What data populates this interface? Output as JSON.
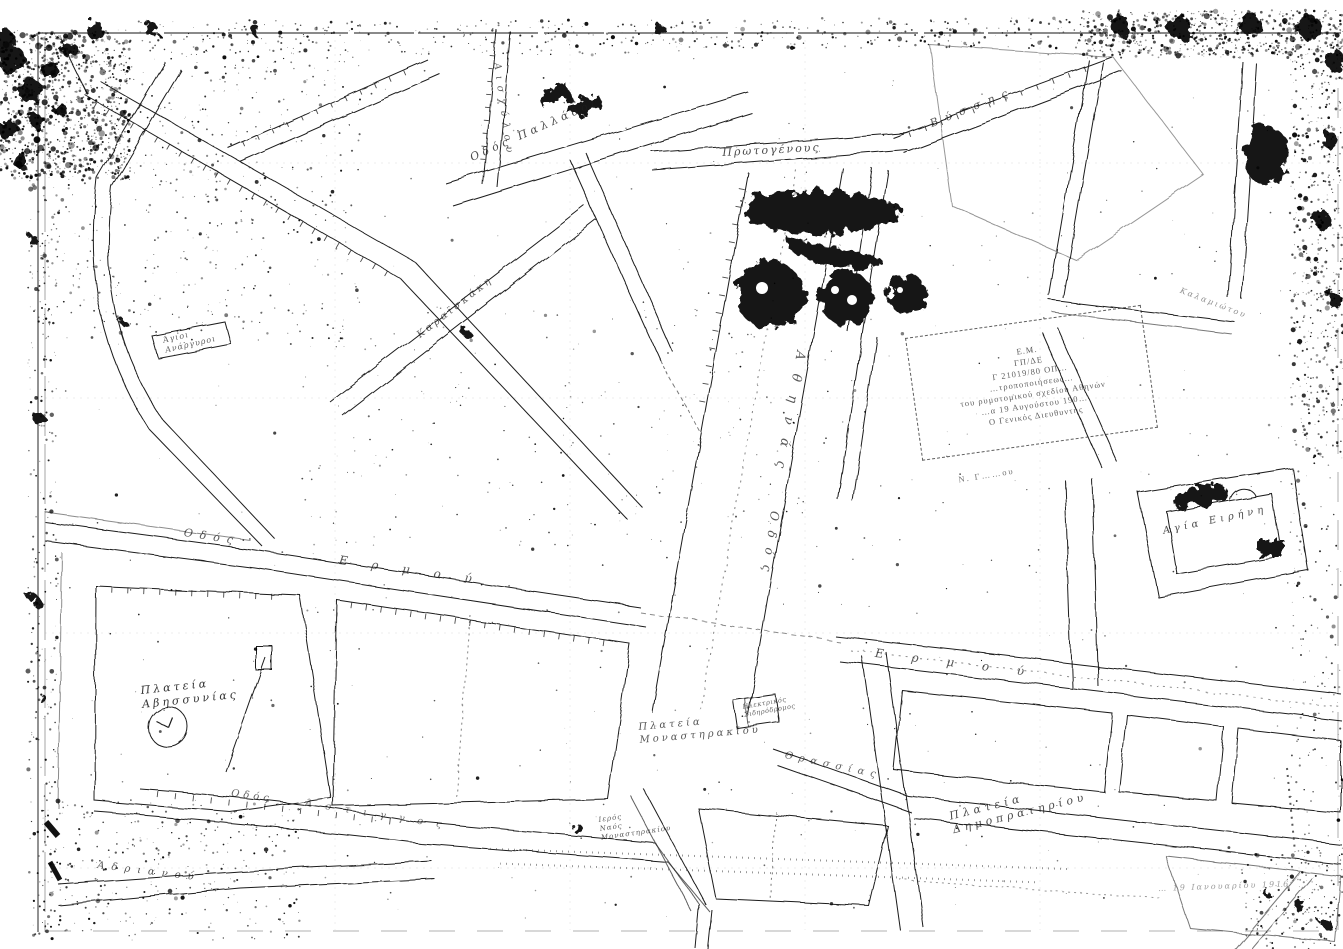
{
  "map": {
    "language": "el",
    "colors": {
      "ink": "#1c1c1c",
      "paper": "#ffffff"
    },
    "labels": [
      {
        "name": "street-label-protogenous",
        "text": "Πρωτογένους",
        "x": 722,
        "y": 146,
        "rot": -3,
        "size": 11,
        "ls": 2,
        "op": 0.8
      },
      {
        "name": "street-label-vyssis",
        "text": "Βύσσης",
        "x": 928,
        "y": 118,
        "rot": -22,
        "size": 11,
        "ls": 8,
        "op": 0.75
      },
      {
        "name": "street-label-pallados",
        "text": "Οδός Παλλάδος",
        "x": 468,
        "y": 152,
        "rot": -24,
        "size": 11,
        "ls": 4,
        "op": 0.8
      },
      {
        "name": "street-label-aischylou",
        "text": "Αισχύλου",
        "x": 502,
        "y": 62,
        "rot": 82,
        "size": 10,
        "ls": 6,
        "op": 0.7
      },
      {
        "name": "street-label-karaiskaki",
        "text": "Καραϊσκάκη",
        "x": 415,
        "y": 332,
        "rot": -38,
        "size": 10,
        "ls": 3,
        "op": 0.7
      },
      {
        "name": "street-label-athinas-name",
        "text": "Αθηνάς",
        "x": 808,
        "y": 352,
        "rot": 100,
        "size": 13,
        "ls": 14,
        "op": 0.75
      },
      {
        "name": "street-label-athinas-odos",
        "text": "Οδός",
        "x": 782,
        "y": 512,
        "rot": 98,
        "size": 12,
        "ls": 10,
        "op": 0.75
      },
      {
        "name": "street-label-ermou-west-odos",
        "text": "Οδός",
        "x": 185,
        "y": 526,
        "rot": 9,
        "size": 11,
        "ls": 7,
        "op": 0.75
      },
      {
        "name": "street-label-ermou-west",
        "text": "Ερμού",
        "x": 340,
        "y": 553,
        "rot": 8,
        "size": 12,
        "ls": 24,
        "op": 0.75
      },
      {
        "name": "street-label-ermou-east",
        "text": "Ερμού",
        "x": 876,
        "y": 646,
        "rot": 7,
        "size": 12,
        "ls": 28,
        "op": 0.75
      },
      {
        "name": "square-label-avissinias",
        "text": "Πλατεία\nΑβησσυνίας",
        "x": 140,
        "y": 684,
        "rot": -6,
        "size": 11,
        "ls": 3,
        "op": 0.9
      },
      {
        "name": "square-label-monastiraki",
        "text": "Πλατεία\nΜοναστηρακίου",
        "x": 638,
        "y": 722,
        "rot": -5,
        "size": 10,
        "ls": 3,
        "op": 0.75
      },
      {
        "name": "square-label-dimopratiriou",
        "text": "Πλατεία\nΔημοπρατηρίου",
        "x": 948,
        "y": 810,
        "rot": -14,
        "size": 11,
        "ls": 4,
        "op": 0.8
      },
      {
        "name": "church-label-agia-irini",
        "text": "Αγία Ειρήνη",
        "x": 1162,
        "y": 526,
        "rot": -12,
        "size": 10,
        "ls": 4,
        "op": 0.8
      },
      {
        "name": "church-label-monastiraki",
        "text": "Ιερός\nΝαός\nΜοναστηρακίου",
        "x": 598,
        "y": 816,
        "rot": -8,
        "size": 7,
        "ls": 1,
        "op": 0.75
      },
      {
        "name": "station-label-electric-railway",
        "text": "Ηλεκτρικός\nΣιδηρόδρομος",
        "x": 742,
        "y": 703,
        "rot": -10,
        "size": 6.5,
        "ls": 0.5,
        "op": 0.7
      },
      {
        "name": "street-label-thrassias",
        "text": "Θρασσίας",
        "x": 786,
        "y": 750,
        "rot": 12,
        "size": 10,
        "ls": 6,
        "op": 0.7
      },
      {
        "name": "street-label-astingos-odos",
        "text": "Οδός",
        "x": 232,
        "y": 788,
        "rot": 8,
        "size": 10,
        "ls": 4,
        "op": 0.7
      },
      {
        "name": "street-label-astingos",
        "text": "Άστιγγος",
        "x": 306,
        "y": 798,
        "rot": 9,
        "size": 10,
        "ls": 13,
        "op": 0.6
      },
      {
        "name": "street-label-adrianou",
        "text": "Αδριανού",
        "x": 98,
        "y": 860,
        "rot": 7,
        "size": 10,
        "ls": 7,
        "op": 0.75
      },
      {
        "name": "church-label-agioi-anargyroi",
        "text": "Άγιοι\nΑνάργυροι",
        "x": 162,
        "y": 336,
        "rot": -13,
        "size": 8,
        "ls": 1,
        "op": 0.7
      },
      {
        "name": "street-label-kalamiotou",
        "text": "Καλαμιώτου",
        "x": 1182,
        "y": 286,
        "rot": 21,
        "size": 8,
        "ls": 2,
        "op": 0.5
      },
      {
        "name": "note-label-date",
        "text": "… 19 Ιανουαρίου 1916",
        "x": 1158,
        "y": 884,
        "rot": -2,
        "size": 8,
        "ls": 2,
        "op": 0.45
      }
    ],
    "stamp": {
      "lines": [
        "Ε.Μ.",
        "ΓΠ/ΔΕ",
        "Γ 21019/80  ΟΠ…",
        "…τροποποιήσεως…",
        "του ρυμοτομικού σχεδίου Αθηνών",
        "…α 19 Αυγούστου 190…",
        "Ο Γενικός Διευθυντής"
      ],
      "signature": "Ν. Γ……ου"
    }
  }
}
